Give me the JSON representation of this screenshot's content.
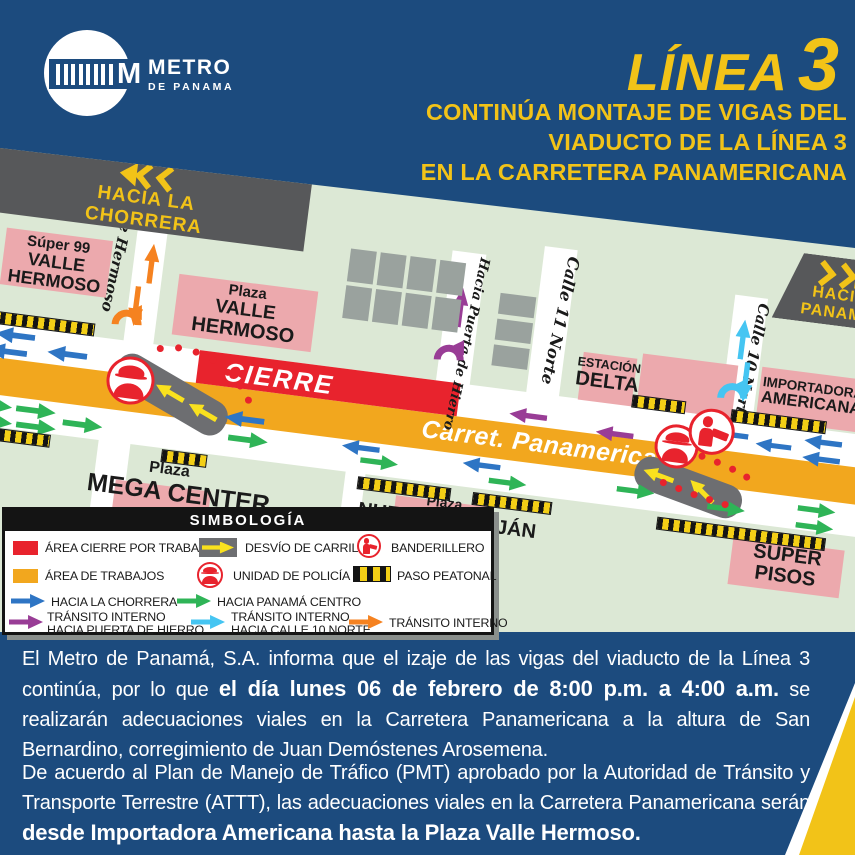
{
  "header": {
    "brand": {
      "name_top": "METRO",
      "name_bottom": "DE PANAMA"
    },
    "line_word": "LÍNEA",
    "line_number": "3",
    "subtitle_lines": [
      "CONTINÚA MONTAJE DE VIGAS DEL",
      "VIADUCTO DE LA LÍNEA 3",
      "EN LA CARRETERA PANAMERICANA"
    ]
  },
  "map": {
    "signs": {
      "west_line1": "HACIA LA",
      "west_line2": "CHORRERA",
      "east_line1": "HACIA",
      "east_line2": "PANAMÁ"
    },
    "roads": {
      "closure": "CIERRE",
      "main": "Carret. Panamericana"
    },
    "streets": {
      "valle_hermoso": "Valle Hermoso",
      "puerta_hierro": "Hacia Puerta de Hierro",
      "calle_11": "Calle 11 Norte",
      "calle_10": "Calle 10 Norte"
    },
    "places": {
      "super99": [
        "Súper 99",
        "VALLE",
        "HERMOSO"
      ],
      "plaza_valle_hermoso": [
        "Plaza",
        "VALLE",
        "HERMOSO"
      ],
      "estacion_delta": [
        "ESTACIÓN",
        "DELTA"
      ],
      "importadora_americana": [
        "IMPORTADORA",
        "AMERICANA"
      ],
      "super_pisos": [
        "SUPER",
        "PISOS"
      ],
      "plaza_mega_center": [
        "Plaza",
        "MEGA CENTER"
      ],
      "plaza_nuevo_arraijan": [
        "Plaza",
        "NUEVO ARRAIJÁN"
      ]
    }
  },
  "legend": {
    "title": "SIMBOLOGÍA",
    "items": {
      "area_cierre": "ÁREA CIERRE POR TRABAJOS",
      "desvio": "DESVÍO DE CARRIL",
      "banderillero": "BANDERILLERO",
      "area_trabajos": "ÁREA DE TRABAJOS",
      "policia": "UNIDAD DE POLICÍA",
      "paso_peatonal": "PASO PEATONAL",
      "chorrera": "HACIA LA CHORRERA",
      "panama_centro": "HACIA PANAMÁ CENTRO",
      "transito_puerta_1": "TRÁNSITO INTERNO",
      "transito_puerta_2": "HACIA PUERTA DE HIERRO",
      "transito_c10_1": "TRÁNSITO INTERNO",
      "transito_c10_2": "HACIA CALLE 10 NORTE",
      "transito": "TRÁNSITO INTERNO"
    }
  },
  "footer": {
    "p1_pre": "El Metro de Panamá, S.A. informa que el izaje de las vigas del viaducto de la Línea 3 continúa, por lo que ",
    "p1_bold": "el día lunes 06 de febrero de 8:00 p.m. a 4:00 a.m.",
    "p1_post": " se realizarán adecuaciones viales en la Carretera Panamericana a la altura de San Bernardino, corregimiento de Juan Demóstenes Arosemena.",
    "p2_pre": "De acuerdo al Plan de Manejo de Tráfico (PMT) aprobado por la Autoridad de Tránsito y Transporte Terrestre (ATTT), las adecuaciones viales en la Carretera Panamericana serán ",
    "p2_bold": "desde Importadora Americana hasta la Plaza Valle Hermoso."
  },
  "colors": {
    "background_blue": "#1c4b7e",
    "accent_yellow": "#f2c318",
    "map_green": "#dce8d5",
    "building_pink": "#eca9ad",
    "closure_red": "#e8232d",
    "works_orange": "#f2a71e",
    "sign_gray": "#57585a",
    "building_gray": "#9aa29e",
    "detour_gray": "#6d6e71",
    "arrow_blue": "#2e75c4",
    "arrow_green": "#2fb457",
    "arrow_purple": "#993d96",
    "arrow_cyan": "#45c5f2",
    "arrow_orange": "#f58220",
    "arrow_yellow": "#f9e11e"
  }
}
